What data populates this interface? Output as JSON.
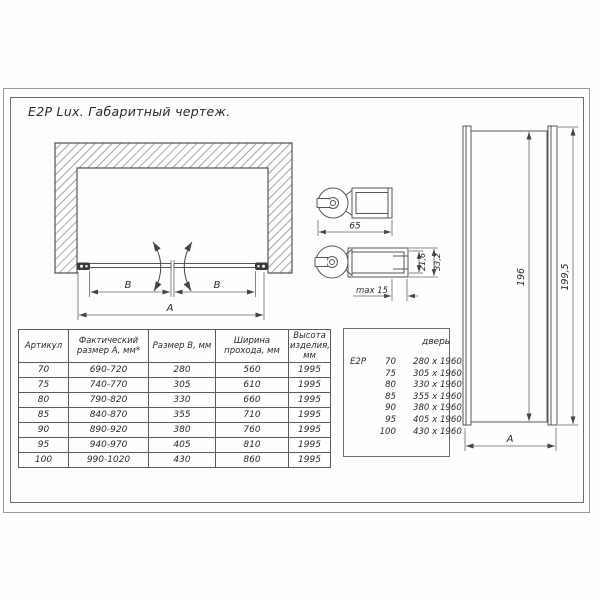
{
  "ink_color": "#4a4a4a",
  "frame": {
    "title": "E2P Lux. Габаритный чертеж."
  },
  "top_view": {
    "dim_b_left": "B",
    "dim_b_right": "B",
    "dim_a": "A"
  },
  "hinge_details": {
    "dim_width": "65",
    "dim_inner": "21,6",
    "dim_outer": "33,2",
    "dim_adjust": "max 15"
  },
  "side_view": {
    "dim_glass_height": "196",
    "dim_total_height": "199,5",
    "dim_width": "A"
  },
  "size_table": {
    "headers": [
      "Артикул",
      "Фактический размер А, мм*",
      "Размер В, мм",
      "Ширина прохода, мм",
      "Высота изделия, мм"
    ],
    "rows": [
      [
        "70",
        "690-720",
        "280",
        "560",
        "1995"
      ],
      [
        "75",
        "740-770",
        "305",
        "610",
        "1995"
      ],
      [
        "80",
        "790-820",
        "330",
        "660",
        "1995"
      ],
      [
        "85",
        "840-870",
        "355",
        "710",
        "1995"
      ],
      [
        "90",
        "890-920",
        "380",
        "760",
        "1995"
      ],
      [
        "95",
        "940-970",
        "405",
        "810",
        "1995"
      ],
      [
        "100",
        "990-1020",
        "430",
        "860",
        "1995"
      ]
    ]
  },
  "door_table": {
    "header": "дверь",
    "rows": [
      [
        "E2P",
        "70",
        "280 x 1960"
      ],
      [
        "",
        "75",
        "305 x 1960"
      ],
      [
        "",
        "80",
        "330 x 1960"
      ],
      [
        "",
        "85",
        "355 x 1960"
      ],
      [
        "",
        "90",
        "380 x 1960"
      ],
      [
        "",
        "95",
        "405 x 1960"
      ],
      [
        "",
        "100",
        "430 x 1960"
      ]
    ]
  }
}
